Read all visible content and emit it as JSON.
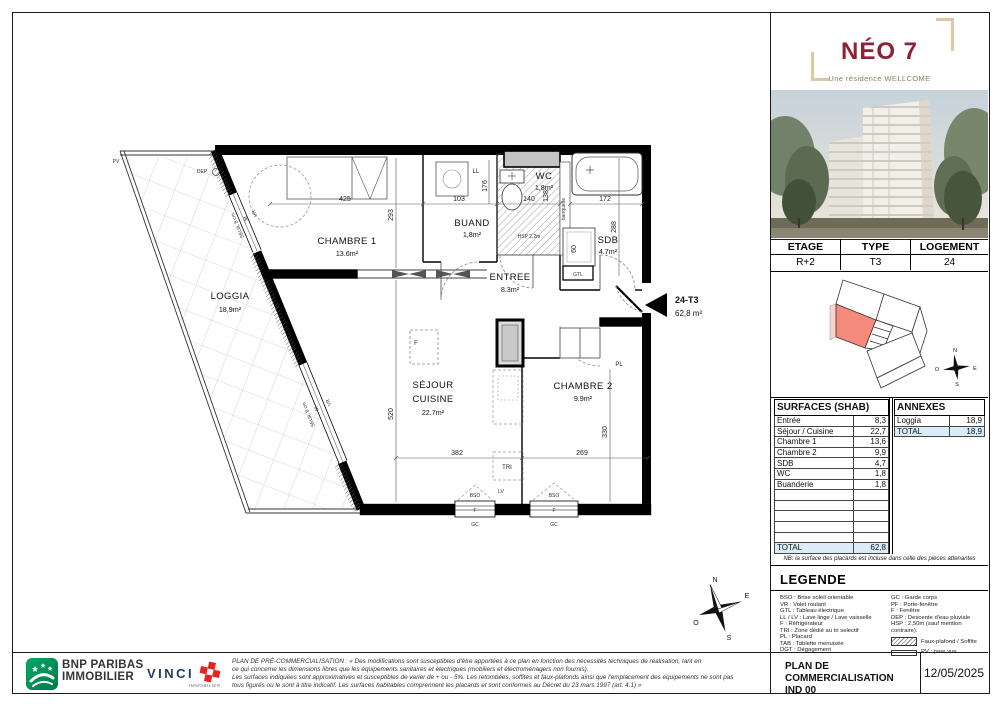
{
  "logo": {
    "title": "NÉO 7",
    "subtitle": "Une résidence WELLCOME"
  },
  "info_table": {
    "headers": [
      "ETAGE",
      "TYPE",
      "LOGEMENT"
    ],
    "values": [
      "R+2",
      "T3",
      "24"
    ]
  },
  "surfaces": {
    "title": "SURFACES (SHAB)",
    "rows": [
      [
        "Entrée",
        "8,3"
      ],
      [
        "Séjour / Cuisine",
        "22,7"
      ],
      [
        "Chambre 1",
        "13,6"
      ],
      [
        "Chambre 2",
        "9,9"
      ],
      [
        "SDB",
        "4,7"
      ],
      [
        "WC",
        "1,8"
      ],
      [
        "Buanderie",
        "1,8"
      ]
    ],
    "total_label": "TOTAL",
    "total_value": "62,8"
  },
  "annexes": {
    "title": "ANNEXES",
    "rows": [
      [
        "Loggia",
        "18,9"
      ]
    ],
    "total_label": "TOTAL",
    "total_value": "18,9"
  },
  "nb_note": "NB: la surface des placards est incluse dans celle des pièces attenantes",
  "legend": {
    "title": "LEGENDE",
    "left": [
      "BSO : Brise soleil orientable",
      "VR : Volet roulant",
      "GTL : Tableau électrique",
      "LL / LV : Lave linge / Lave vaisselle",
      "F : Réfrigérateur",
      "TRI : Zone dédié au tri selectif",
      "PL : Placard",
      "TAB : Tablette menuisée",
      "DGT : Dégagement"
    ],
    "right": [
      "GC : Garde corps",
      "PF : Porte-fenêtre",
      "F : Fenêtre",
      "DEP : Descente d'eau pluviale",
      "HSP : 2,50m (sauf mention contraire)."
    ],
    "sym_hatch": "Faux-plafond / Soffite",
    "sym_pv": "PV : pare vue"
  },
  "footer": {
    "bnp_line1": "BNP PARIBAS",
    "bnp_line2": "IMMOBILIER",
    "vinci": "VINCI",
    "vinci_sub": "IMMOBILIER",
    "disclaimer": [
      "PLAN DE PRÉ-COMMERCIALISATION : « Des modifications sont susceptibles d'être apportées à ce plan en fonction des nécessités techniques de réalisation, tant en",
      "ce qui concerne les dimensions libres que les équipements sanitaires et électriques (mobiliers et électroménagers non fournis).",
      "Les surfaces indiquées sont approximatives et susceptibles de varier de + ou - 5%. Les retombées, soffites et faux-plafonds ainsi que l'emplacement des équipements ne sont pas",
      "tous figurés ou le sont à titre indicatif. Les surfaces habitables comprennent les placards et sont conformes au Décret du 23 mars 1997 (art. 4.1) »"
    ],
    "block_line1": "PLAN DE COMMERCIALISATION",
    "block_line2": "IND 00",
    "date": "12/05/2025"
  },
  "plan": {
    "unit": {
      "code": "24-T3",
      "area": "62,8 m²"
    },
    "rooms": {
      "loggia": {
        "name": "LOGGIA",
        "area": "18,9m²"
      },
      "chambre1": {
        "name": "CHAMBRE 1",
        "area": "13.6m²"
      },
      "buand": {
        "name": "BUAND",
        "area": "1,8m²"
      },
      "wc": {
        "name": "WC",
        "area": "1,8m²"
      },
      "sdb": {
        "name": "SDB",
        "area": "4.7m²"
      },
      "entree": {
        "name": "ENTREE",
        "area": "8.3m²"
      },
      "sejour": {
        "l1": "SÉJOUR",
        "l2": "CUISINE",
        "area": "22.7m²"
      },
      "chambre2": {
        "name": "CHAMBRE 2",
        "area": "9.9m²"
      }
    },
    "dims": {
      "d425": "425",
      "d293": "293",
      "d103": "103",
      "d176": "176",
      "d140": "140",
      "d138": "138",
      "d172": "172",
      "d288": "288",
      "d520": "520",
      "d382": "382",
      "d269": "269",
      "d330": "330",
      "d60": "60"
    },
    "tags": {
      "pv": "PV",
      "dep": "DEP",
      "ll": "LL",
      "gtl": "GTL",
      "tri": "TRI",
      "lv": "LV",
      "pl": "PL",
      "f": "F",
      "gc": "GC",
      "bso": "BSO",
      "vr": "VR",
      "m": "M",
      "seuil": "SEUIL 8 cm",
      "banquette": "banquette",
      "hsp": "HSP 2,2m"
    },
    "compass": {
      "n": "N",
      "s": "S",
      "e": "E",
      "o": "O"
    }
  }
}
